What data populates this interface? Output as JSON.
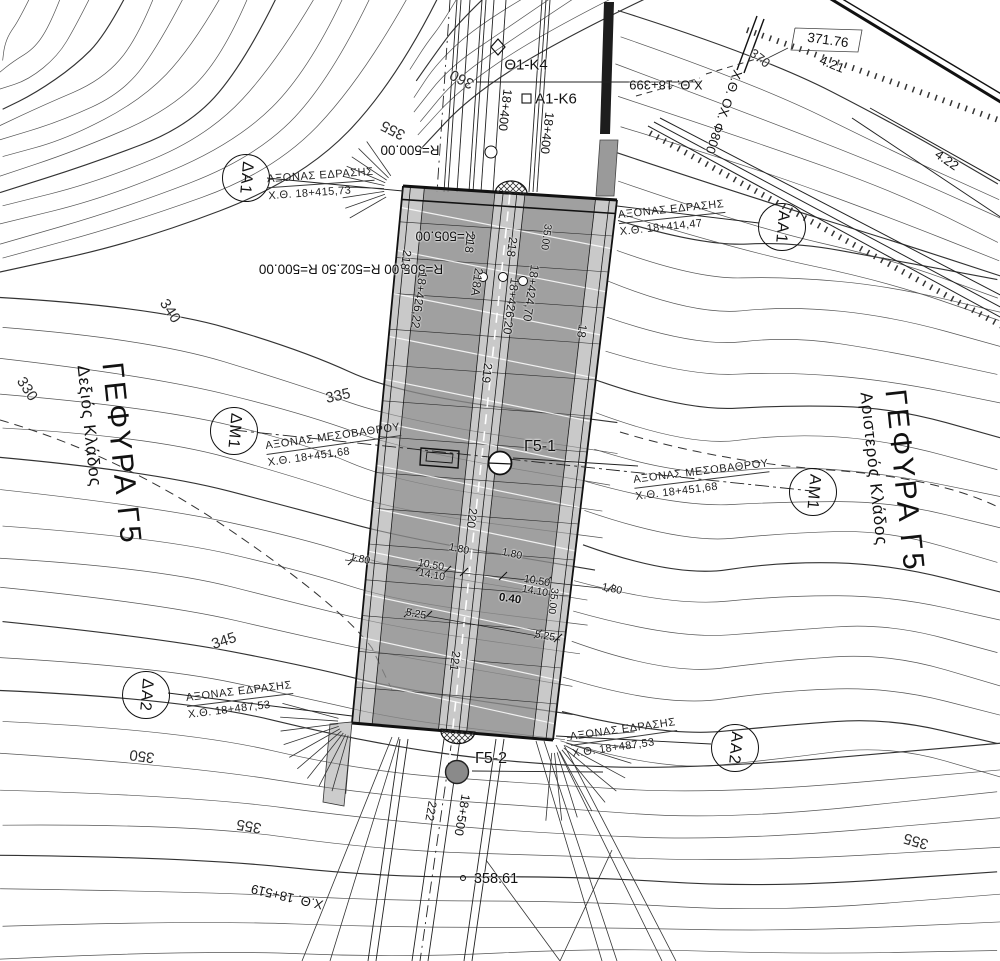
{
  "drawing_type": "bridge site plan (topographic)",
  "colors": {
    "paper": "#ffffff",
    "ink": "#1a1a1a",
    "contour": "#4a4a4a",
    "deck_fill": "#a8a8a8",
    "roadway_fill": "#787878"
  },
  "titles": [
    {
      "id": "left",
      "title": "ΓΕΦΥΡΑ Γ5",
      "subtitle": "Δεξιός Κλάδος",
      "x": 110,
      "y": 455,
      "rot": 84
    },
    {
      "id": "right",
      "title": "ΓΕΦΥΡΑ Γ5",
      "subtitle": "Αριστερός Κλάδος",
      "x": 893,
      "y": 482,
      "rot": 84
    }
  ],
  "markers": [
    {
      "id": "da1",
      "label": "ΔΑ1",
      "x": 245,
      "y": 177
    },
    {
      "id": "aa1",
      "label": "ΑΑ1",
      "x": 781,
      "y": 226
    },
    {
      "id": "dm1",
      "label": "ΔΜ1",
      "x": 233,
      "y": 430
    },
    {
      "id": "am1",
      "label": "ΑΜ1",
      "x": 812,
      "y": 491
    },
    {
      "id": "da2",
      "label": "ΔΑ2",
      "x": 145,
      "y": 694
    },
    {
      "id": "aa2",
      "label": "ΑΑ2",
      "x": 734,
      "y": 747
    }
  ],
  "annotations": [
    {
      "title": "ΑΞΟΝΑΣ ΕΔΡΑΣΗΣ",
      "station": "Χ.Θ. 18+415,73",
      "x": 321,
      "y": 184,
      "rot": -4
    },
    {
      "title": "ΑΞΟΝΑΣ ΕΔΡΑΣΗΣ",
      "station": "Χ.Θ. 18+414,47",
      "x": 672,
      "y": 218,
      "rot": -6
    },
    {
      "title": "ΑΞΟΝΑΣ ΜΕΣΟΒΑΘΡΟΥ",
      "station": "Χ.Θ. 18+451,68",
      "x": 334,
      "y": 445,
      "rot": -8
    },
    {
      "title": "ΑΞΟΝΑΣ ΜΕΣΟΒΑΘΡΟΥ",
      "station": "Χ.Θ. 18+451,68",
      "x": 702,
      "y": 480,
      "rot": -7
    },
    {
      "title": "ΑΞΟΝΑΣ ΕΔΡΑΣΗΣ",
      "station": "Χ.Θ. 18+487,53",
      "x": 240,
      "y": 700,
      "rot": -7
    },
    {
      "title": "ΑΞΟΝΑΣ ΕΔΡΑΣΗΣ",
      "station": "Χ.Θ. 18+487,53",
      "x": 624,
      "y": 738,
      "rot": -8
    }
  ],
  "labels": [
    {
      "t": "360",
      "x": 462,
      "y": 79,
      "r": 207,
      "s": 15,
      "k": "contour"
    },
    {
      "t": "355",
      "x": 393,
      "y": 130,
      "r": 207,
      "s": 15,
      "k": "contour"
    },
    {
      "t": "340",
      "x": 170,
      "y": 311,
      "r": 57,
      "s": 15,
      "k": "contour"
    },
    {
      "t": "330",
      "x": 27,
      "y": 389,
      "r": 57,
      "s": 15,
      "k": "contour"
    },
    {
      "t": "335",
      "x": 338,
      "y": 396,
      "r": -12,
      "s": 15,
      "k": "contour"
    },
    {
      "t": "345",
      "x": 224,
      "y": 641,
      "r": -18,
      "s": 15,
      "k": "contour"
    },
    {
      "t": "350",
      "x": 142,
      "y": 756,
      "r": 188,
      "s": 15,
      "k": "contour"
    },
    {
      "t": "355",
      "x": 249,
      "y": 826,
      "r": 190,
      "s": 15,
      "k": "contour"
    },
    {
      "t": "355",
      "x": 916,
      "y": 841,
      "r": 196,
      "s": 15,
      "k": "contour"
    },
    {
      "t": "370",
      "x": 760,
      "y": 58,
      "r": 38,
      "s": 13,
      "k": "contour"
    },
    {
      "t": "R=500.00",
      "x": 410,
      "y": 150,
      "r": 180,
      "s": 13.5,
      "k": "radius"
    },
    {
      "t": "R=505.00",
      "x": 445,
      "y": 236,
      "r": 180,
      "s": 13.5,
      "k": "radius"
    },
    {
      "t": "R=505.00 R=502.50 R=500.00",
      "x": 351,
      "y": 269,
      "r": 180,
      "s": 13.5,
      "k": "radius"
    },
    {
      "t": "Θ1-Κ4",
      "x": 526,
      "y": 65,
      "r": 0,
      "s": 15,
      "k": "chain"
    },
    {
      "t": "Α1-Κ6",
      "x": 556,
      "y": 99,
      "r": 0,
      "s": 15,
      "k": "chain"
    },
    {
      "t": "18+400",
      "x": 505,
      "y": 110,
      "r": 97,
      "s": 12.5,
      "k": "chain"
    },
    {
      "t": "18+400",
      "x": 547,
      "y": 133,
      "r": 97,
      "s": 12.5,
      "k": "chain"
    },
    {
      "t": "Χ.Θ. 18+399",
      "x": 666,
      "y": 85,
      "r": 180,
      "s": 13,
      "k": "chain"
    },
    {
      "t": "Χ.Θ. ΟΧ. Φ800",
      "x": 724,
      "y": 112,
      "r": 109,
      "s": 13,
      "k": "chain"
    },
    {
      "t": "Χ.Θ. 18+519",
      "x": 287,
      "y": 897,
      "r": 193,
      "s": 13,
      "k": "chain"
    },
    {
      "t": "18+500",
      "x": 462,
      "y": 815,
      "r": 100,
      "s": 12.5,
      "k": "chain"
    },
    {
      "t": "218",
      "x": 406,
      "y": 260,
      "r": 98,
      "s": 12,
      "k": "axis"
    },
    {
      "t": "18+426,22",
      "x": 419,
      "y": 300,
      "r": 98,
      "s": 12,
      "k": "axis"
    },
    {
      "t": "218",
      "x": 470,
      "y": 243,
      "r": 98,
      "s": 12,
      "k": "axis"
    },
    {
      "t": "218Α",
      "x": 477,
      "y": 282,
      "r": 98,
      "s": 12,
      "k": "axis"
    },
    {
      "t": "218",
      "x": 512,
      "y": 247,
      "r": 98,
      "s": 12,
      "k": "axis"
    },
    {
      "t": "18+424,70",
      "x": 531,
      "y": 293,
      "r": 98,
      "s": 12,
      "k": "axis"
    },
    {
      "t": "18+426,20",
      "x": 511,
      "y": 306,
      "r": 98,
      "s": 12,
      "k": "axis"
    },
    {
      "t": "219",
      "x": 487,
      "y": 373,
      "r": 97,
      "s": 12,
      "k": "axis"
    },
    {
      "t": "220",
      "x": 472,
      "y": 518,
      "r": 97,
      "s": 12,
      "k": "axis"
    },
    {
      "t": "221",
      "x": 455,
      "y": 661,
      "r": 98,
      "s": 12,
      "k": "axis"
    },
    {
      "t": "222",
      "x": 431,
      "y": 811,
      "r": 100,
      "s": 12,
      "k": "axis"
    },
    {
      "t": "18",
      "x": 582,
      "y": 331,
      "r": 98,
      "s": 12,
      "k": "axis"
    },
    {
      "t": "35.00",
      "x": 553,
      "y": 601,
      "r": 97,
      "s": 10.5,
      "k": "axis"
    },
    {
      "t": "35.00",
      "x": 546,
      "y": 237,
      "r": 98,
      "s": 10.5,
      "k": "axis"
    },
    {
      "t": "1.80",
      "x": 360,
      "y": 559,
      "r": 12,
      "s": 10.5,
      "k": "dim"
    },
    {
      "t": "1.80",
      "x": 459,
      "y": 549,
      "r": 12,
      "s": 10.5,
      "k": "dim"
    },
    {
      "t": "1.80",
      "x": 512,
      "y": 554,
      "r": 12,
      "s": 10.5,
      "k": "dim"
    },
    {
      "t": "1.80",
      "x": 612,
      "y": 589,
      "r": 12,
      "s": 10.5,
      "k": "dim"
    },
    {
      "t": "10.50",
      "x": 431,
      "y": 565,
      "r": 10,
      "s": 10.5,
      "k": "dim"
    },
    {
      "t": "14.10",
      "x": 432,
      "y": 575,
      "r": 10,
      "s": 10.5,
      "k": "dim"
    },
    {
      "t": "10.50",
      "x": 537,
      "y": 581,
      "r": 10,
      "s": 10.5,
      "k": "dim"
    },
    {
      "t": "14.10",
      "x": 535,
      "y": 591,
      "r": 10,
      "s": 10.5,
      "k": "dim"
    },
    {
      "t": "5.25",
      "x": 416,
      "y": 614,
      "r": 10,
      "s": 10.5,
      "k": "dim"
    },
    {
      "t": "5.25",
      "x": 545,
      "y": 636,
      "r": 10,
      "s": 10.5,
      "k": "dim"
    },
    {
      "t": "0.40",
      "x": 510,
      "y": 599,
      "r": 8,
      "s": 11.5,
      "k": "dim dim0"
    },
    {
      "t": "Γ5-1",
      "x": 540,
      "y": 447,
      "r": 0,
      "s": 16,
      "k": "feat"
    },
    {
      "t": "Γ5-2",
      "x": 491,
      "y": 759,
      "r": 0,
      "s": 16,
      "k": "feat"
    },
    {
      "t": "371.76",
      "x": 828,
      "y": 40,
      "r": 8,
      "s": 13.5,
      "k": "feat"
    },
    {
      "t": "4.21",
      "x": 832,
      "y": 64,
      "r": 22,
      "s": 13,
      "k": "feat"
    },
    {
      "t": "4.22",
      "x": 947,
      "y": 160,
      "r": 35,
      "s": 13,
      "k": "feat"
    },
    {
      "t": "358.61",
      "x": 496,
      "y": 879,
      "r": 0,
      "s": 14.5,
      "k": "feat"
    }
  ]
}
